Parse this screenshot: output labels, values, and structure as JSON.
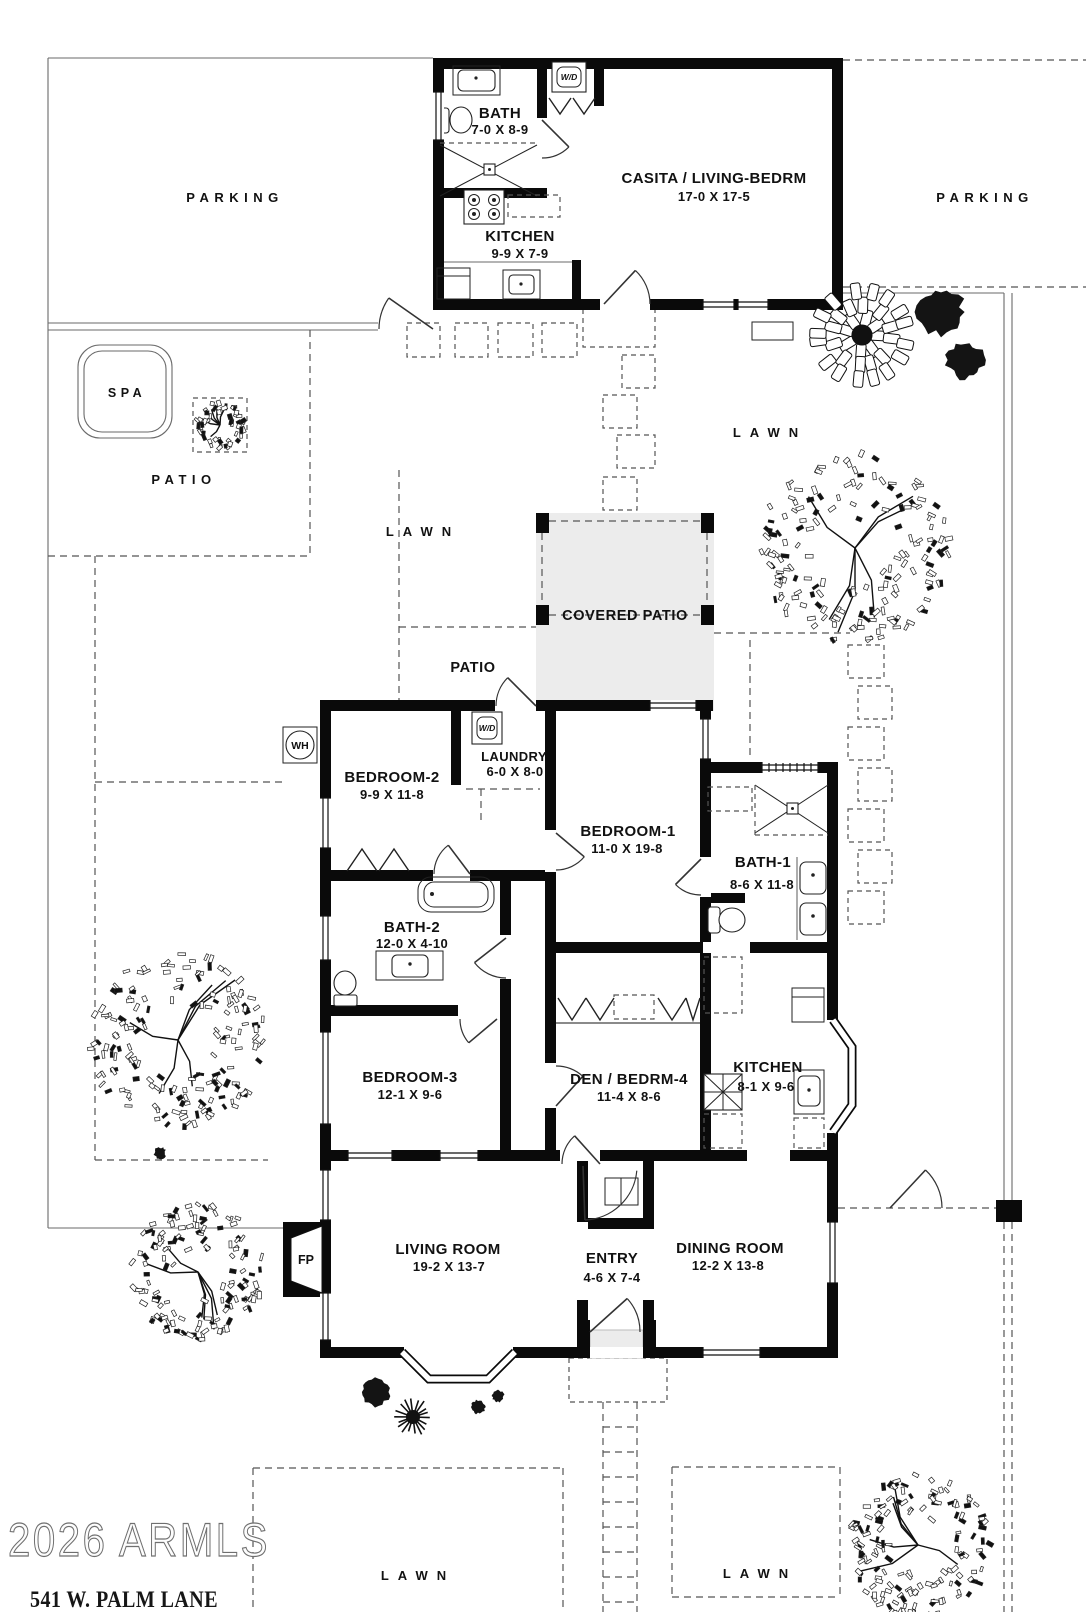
{
  "site": {
    "watermark": "2026 ARMLS",
    "address": "541 W. PALM  LANE",
    "labels": {
      "parking_left": "PARKING",
      "parking_right": "PARKING",
      "spa": "SPA",
      "patio_left": "PATIO",
      "patio_mid": "PATIO",
      "covered_patio": "COVERED PATIO",
      "lawn_left": "LAWN",
      "lawn_upper_right": "LAWN",
      "lawn_bottom_left": "LAWN",
      "lawn_bottom_right": "LAWN"
    }
  },
  "casita": {
    "bath": {
      "name": "BATH",
      "dims": "7-0 X 8-9"
    },
    "kitchen": {
      "name": "KITCHEN",
      "dims": "9-9 X 7-9"
    },
    "living": {
      "name": "CASITA / LIVING-BEDRM",
      "dims": "17-0  X  17-5"
    },
    "wd": "W/D"
  },
  "house": {
    "bedroom2": {
      "name": "BEDROOM-2",
      "dims": "9-9  X  11-8"
    },
    "laundry": {
      "name": "LAUNDRY",
      "dims": "6-0 X 8-0"
    },
    "bedroom1": {
      "name": "BEDROOM-1",
      "dims": "11-0  X  19-8"
    },
    "bath1": {
      "name": "BATH-1",
      "dims": "8-6 X 11-8"
    },
    "bath2": {
      "name": "BATH-2",
      "dims": "12-0 X 4-10"
    },
    "bedroom3": {
      "name": "BEDROOM-3",
      "dims": "12-1  X  9-6"
    },
    "den": {
      "name": "DEN / BEDRM-4",
      "dims": "11-4  X  8-6"
    },
    "kitchen": {
      "name": "KITCHEN",
      "dims": "8-1 X 9-6"
    },
    "living_room": {
      "name": "LIVING ROOM",
      "dims": "19-2  X  13-7"
    },
    "entry": {
      "name": "ENTRY",
      "dims": "4-6 X 7-4"
    },
    "dining_room": {
      "name": "DINING ROOM",
      "dims": "12-2  X  13-8"
    },
    "fireplace": "FP",
    "water_heater": "WH",
    "wd": "W/D"
  }
}
